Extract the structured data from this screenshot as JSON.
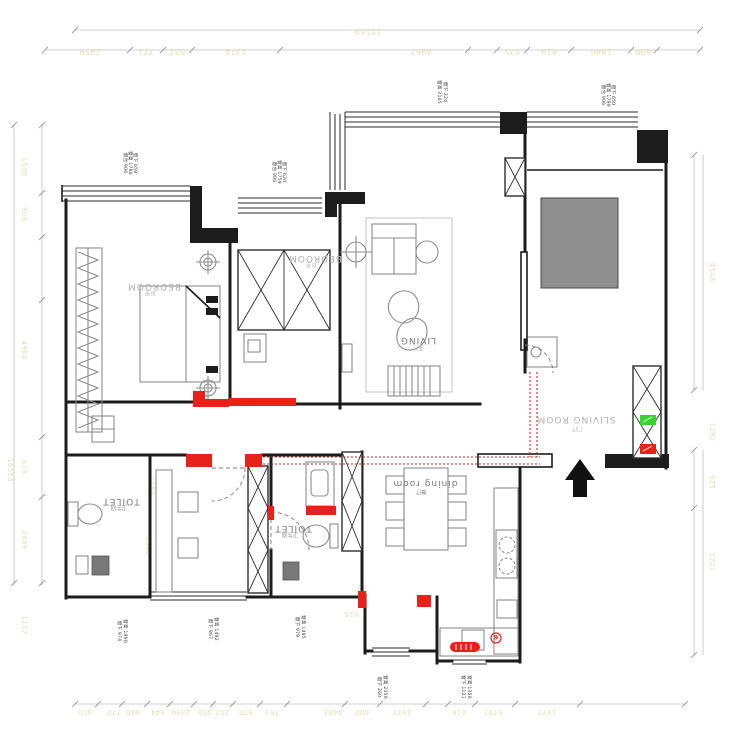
{
  "plan": {
    "rooms": {
      "bedroom1": {
        "label": "BEDROOM",
        "sub": "卧室"
      },
      "bedroom2": {
        "label": "BEDROOM",
        "sub": "卧室"
      },
      "living": {
        "label": "LIVING",
        "sub": "客厅"
      },
      "entry": {
        "label": "SLIVING ROOM",
        "sub": "门厅"
      },
      "dining": {
        "label": "dining room",
        "sub": "餐厅"
      },
      "toilet1": {
        "label": "TOILET",
        "sub": "卫生间"
      },
      "toilet2": {
        "label": "TOILET",
        "sub": "卫生间"
      }
    },
    "window_notes": [
      {
        "l1": "窗台 906",
        "l2": "窗高 1786",
        "l3": "窗下 659"
      },
      {
        "l1": "窗台 906",
        "l2": "窗高 1759",
        "l3": "窗下 620"
      },
      {
        "l1": "窗高 2165",
        "l2": "窗下 224",
        "l3": ""
      },
      {
        "l1": "窗台 906",
        "l2": "窗高 1799",
        "l3": "窗下 650"
      },
      {
        "l1": "窗下 974",
        "l2": "窗高 1990",
        "l3": ""
      },
      {
        "l1": "窗下 967",
        "l2": "窗高 1492",
        "l3": ""
      },
      {
        "l1": "窗下 979",
        "l2": "窗高 1495",
        "l3": ""
      },
      {
        "l1": "窗下 260",
        "l2": "窗高 2350",
        "l3": ""
      },
      {
        "l1": "窗下 1121",
        "l2": "窗高 1356",
        "l3": ""
      }
    ],
    "dims": {
      "top_total": "15169",
      "top": [
        "2959",
        "771",
        "557",
        "2374",
        "4967",
        "575",
        "619",
        "1866",
        "600"
      ],
      "left_total": "16553",
      "left": [
        "1536",
        "908",
        "4964",
        "619",
        "2689",
        "1117"
      ],
      "bottom": [
        "300",
        "770",
        "940",
        "944",
        "2090",
        "350",
        "707",
        "970",
        "763",
        "4463",
        "600",
        "3977",
        "616",
        "6767",
        "1677"
      ],
      "right": [
        "4548",
        "1292",
        "975",
        "3721"
      ],
      "inner": [
        "1188",
        "1590",
        "625"
      ]
    },
    "badge": "6",
    "colors": {
      "wall": "#1c1c1c",
      "red": "#e8221a",
      "green": "#35d62c",
      "dim_text": "#e5deb2",
      "furniture": "#8d8d8d"
    }
  }
}
